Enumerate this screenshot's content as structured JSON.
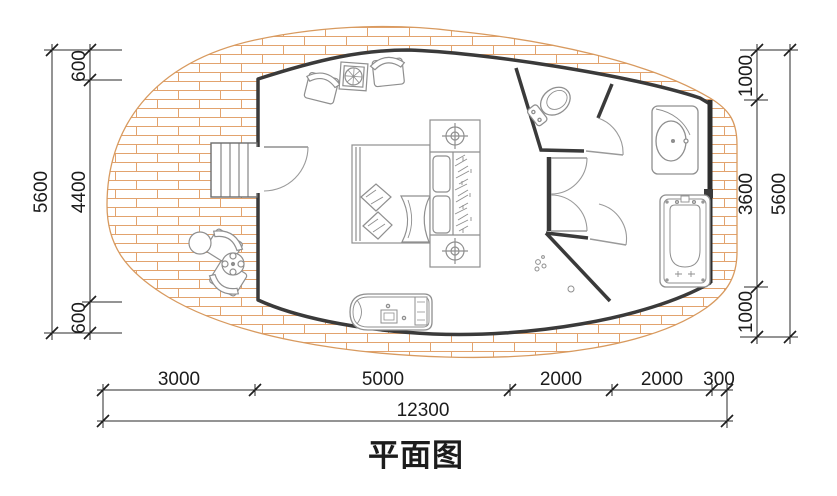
{
  "title": "平面图",
  "colors": {
    "deck_hatch": "#e2a36e",
    "deck_edge": "#d89a5f",
    "wall": "#3a3a3a",
    "furniture": "#8f8f8f",
    "dimension_line": "#2a2a2a"
  },
  "dimensions": {
    "left": {
      "total": "5600",
      "segments": [
        "600",
        "4400",
        "600"
      ]
    },
    "right": {
      "total": "5600",
      "segments": [
        "1000",
        "3600",
        "1000"
      ]
    },
    "bottom": {
      "total": "12300",
      "segments": [
        "3000",
        "5000",
        "2000",
        "2000",
        "300"
      ]
    }
  },
  "fixtures": {
    "deck": "wood-deck",
    "stairs": "entry-steps",
    "entry_door": "entry-door",
    "bed": "double-bed",
    "wardrobe": "wardrobe-with-hangers",
    "nightstand": "lamp-table",
    "toilet": "toilet",
    "sink": "washbasin",
    "bathtub": "bathtub",
    "shower": "shower-drain",
    "chairs": "armchairs",
    "round_table": "deck-table",
    "bench": "lounge-bench"
  }
}
